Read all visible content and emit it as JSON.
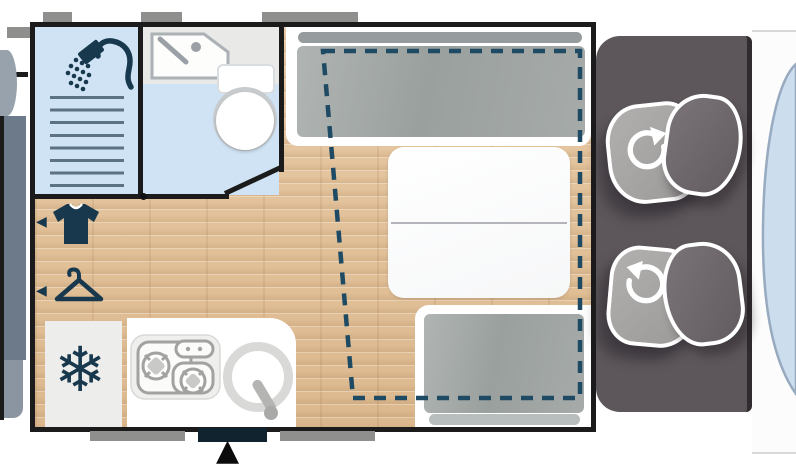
{
  "meta": {
    "title": "Campervan floor plan diagram",
    "text_visible": false
  },
  "glyphs": {
    "snowflake": "❄",
    "entry_arrow": "▲",
    "wardrobe_arrow_left": "◀"
  },
  "labels": {
    "floorplan": "motorhome floor plan",
    "adjacent_plan_sliver": "edge of adjacent floor plan",
    "shower_room": "shower room",
    "shower_icon": "shower head",
    "shower_drain": "shower drain lines",
    "washroom": "washroom with toilet",
    "washbasin_icon": "washbasin",
    "toilet": "toilet",
    "wardrobe_tshirt": "wardrobe (shirt storage)",
    "wardrobe_hanger": "wardrobe (hanging storage)",
    "fridge": "refrigerator",
    "kitchen": "kitchen block",
    "stove_icon": "two-burner gas stove",
    "kitchen_sink_icon": "kitchen sink with faucet",
    "front_bench": "forward bench seat with cushion",
    "table": "folding dinette table",
    "rear_bench": "rear bench seat with cushion",
    "dropdown_bed": "drop-down bed outline (dashed)",
    "entry_door": "entry door",
    "entry_arrow": "entrance arrow",
    "window": "window",
    "cab": "driver cab",
    "swivel_seat_driver": "swivel cab seat (driver)",
    "swivel_seat_passenger": "swivel cab seat (passenger)",
    "rotate_icon": "swivel rotation arrow",
    "windshield": "windshield"
  },
  "colors": {
    "wall": "#1b1b1b",
    "accent_navy_icons": "#17384d",
    "bed_outline_dash": "#1f4a63",
    "wet_room_blue": "#cfe3f4",
    "counter_gray": "#e9e9e7",
    "wood_floor": "#e0bf98",
    "cushion_gray": "#a0a5a3",
    "window_gray": "#8f8f8d",
    "entry_door_navy": "#10232f",
    "cab_gray": "#5d575b",
    "seat_light": "#a7a5a3",
    "seat_dark": "#6c666a",
    "windshield_blue": "#ccddee",
    "adjacent_bed_slate": "#6d7a89"
  },
  "floorplan": {
    "zones": [
      {
        "name": "shower-room",
        "icons": [
          "shower-head",
          "drain-lines"
        ]
      },
      {
        "name": "washroom",
        "icons": [
          "washbasin",
          "toilet"
        ]
      },
      {
        "name": "wardrobes",
        "icons": [
          "tshirt",
          "hanger"
        ],
        "arrows": 2
      },
      {
        "name": "galley",
        "icons": [
          "snowflake-fridge",
          "two-burner-stove",
          "round-sink"
        ]
      },
      {
        "name": "dinette",
        "items": [
          "front-bench",
          "folding-table",
          "rear-bench",
          "drop-down-bed-dashed-outline"
        ]
      },
      {
        "name": "cab",
        "items": [
          "swivel-seat-driver",
          "swivel-seat-passenger",
          "windshield"
        ]
      }
    ],
    "openings": {
      "top_windows": 3,
      "bottom_windows": 2,
      "entry_door_with_arrow": true
    }
  }
}
